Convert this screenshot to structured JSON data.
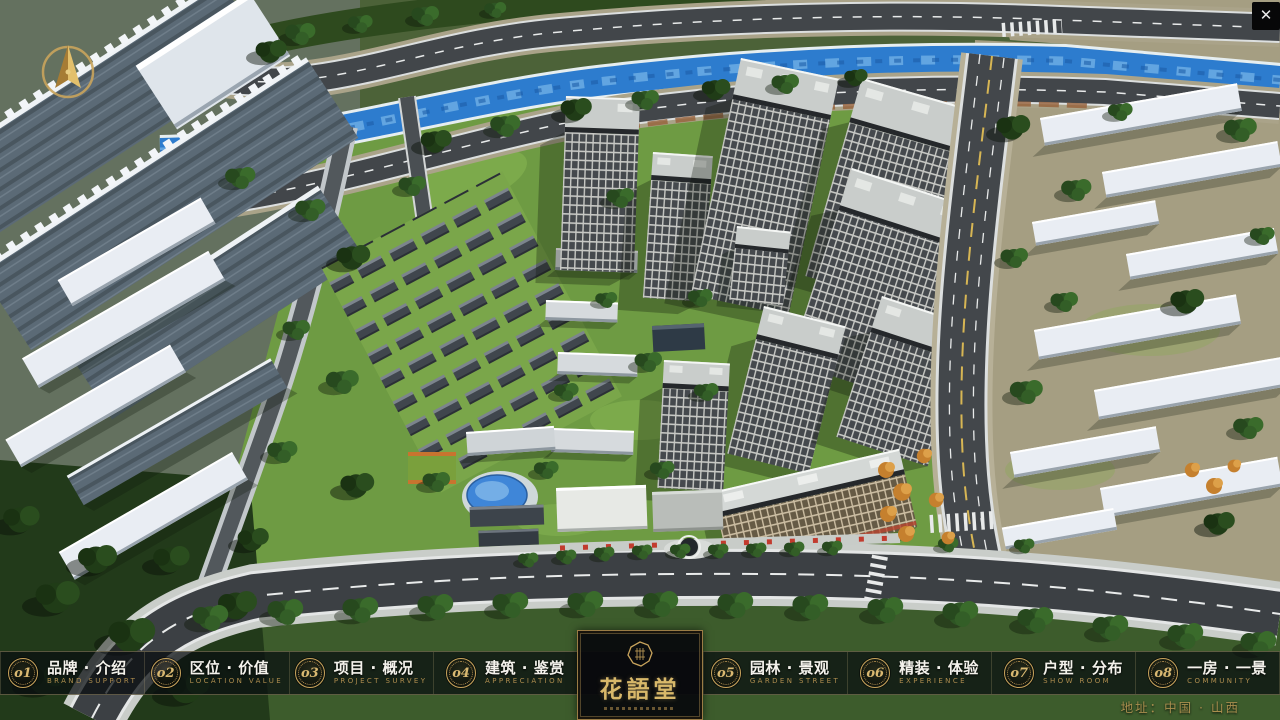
{
  "window": {
    "close_glyph": "✕"
  },
  "menu": {
    "items": [
      {
        "num": "o1",
        "zh": "品牌 · 介绍",
        "en": "BRAND SUPPORT"
      },
      {
        "num": "o2",
        "zh": "区位 · 价值",
        "en": "LOCATION VALUE"
      },
      {
        "num": "o3",
        "zh": "项目 · 概况",
        "en": "PROJECT SURVEY"
      },
      {
        "num": "o4",
        "zh": "建筑 · 鉴赏",
        "en": "APPRECIATION"
      },
      {
        "num": "o5",
        "zh": "园林 · 景观",
        "en": "GARDEN STREET"
      },
      {
        "num": "o6",
        "zh": "精装 · 体验",
        "en": "EXPERIENCE"
      },
      {
        "num": "o7",
        "zh": "户型 · 分布",
        "en": "SHOW ROOM"
      },
      {
        "num": "o8",
        "zh": "一房 · 一景",
        "en": "COMMUNITY"
      }
    ]
  },
  "logo": {
    "title": "花語堂"
  },
  "footer": {
    "address": "地址：中国 · 山西"
  },
  "icons": {
    "close_glyph": "✕"
  },
  "colors": {
    "gold": "#c9a45c",
    "river_blue": "#2d7cce",
    "grass_green": "#6e9b43",
    "road_asphalt": "#42464a"
  }
}
